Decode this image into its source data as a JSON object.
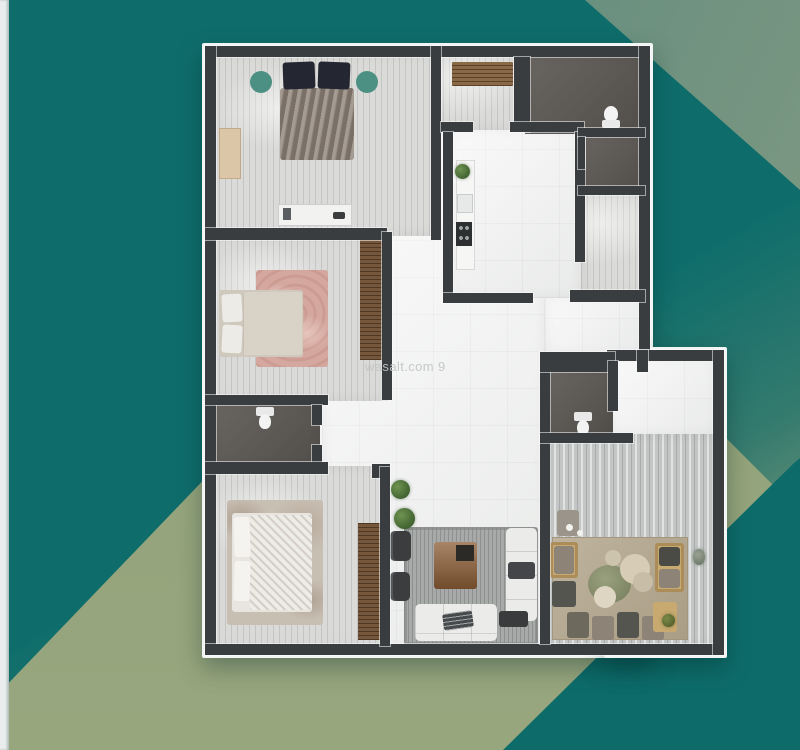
{
  "watermark": {
    "text": "wasalt.com 9"
  },
  "palette": {
    "background_teal": "#0e6d6b",
    "background_sage": "#98a67e",
    "corner_gradient_start": "#2f7a73",
    "corner_gradient_end": "#869c82",
    "edge_strip": "#e9edec",
    "wall": "#3a3d40",
    "accent_circle": "#4b9082",
    "watermark_color": "#c2c7c4"
  },
  "floorplan": {
    "type": "apartment-top-view-render",
    "rooms": [
      "master-bedroom",
      "bedroom-2",
      "bedroom-3",
      "kitchen",
      "entry-hall",
      "bathroom-1",
      "shower-room",
      "bathroom-2",
      "bathroom-3",
      "corridor",
      "hallway",
      "vestibule",
      "living-room",
      "majlis"
    ]
  }
}
